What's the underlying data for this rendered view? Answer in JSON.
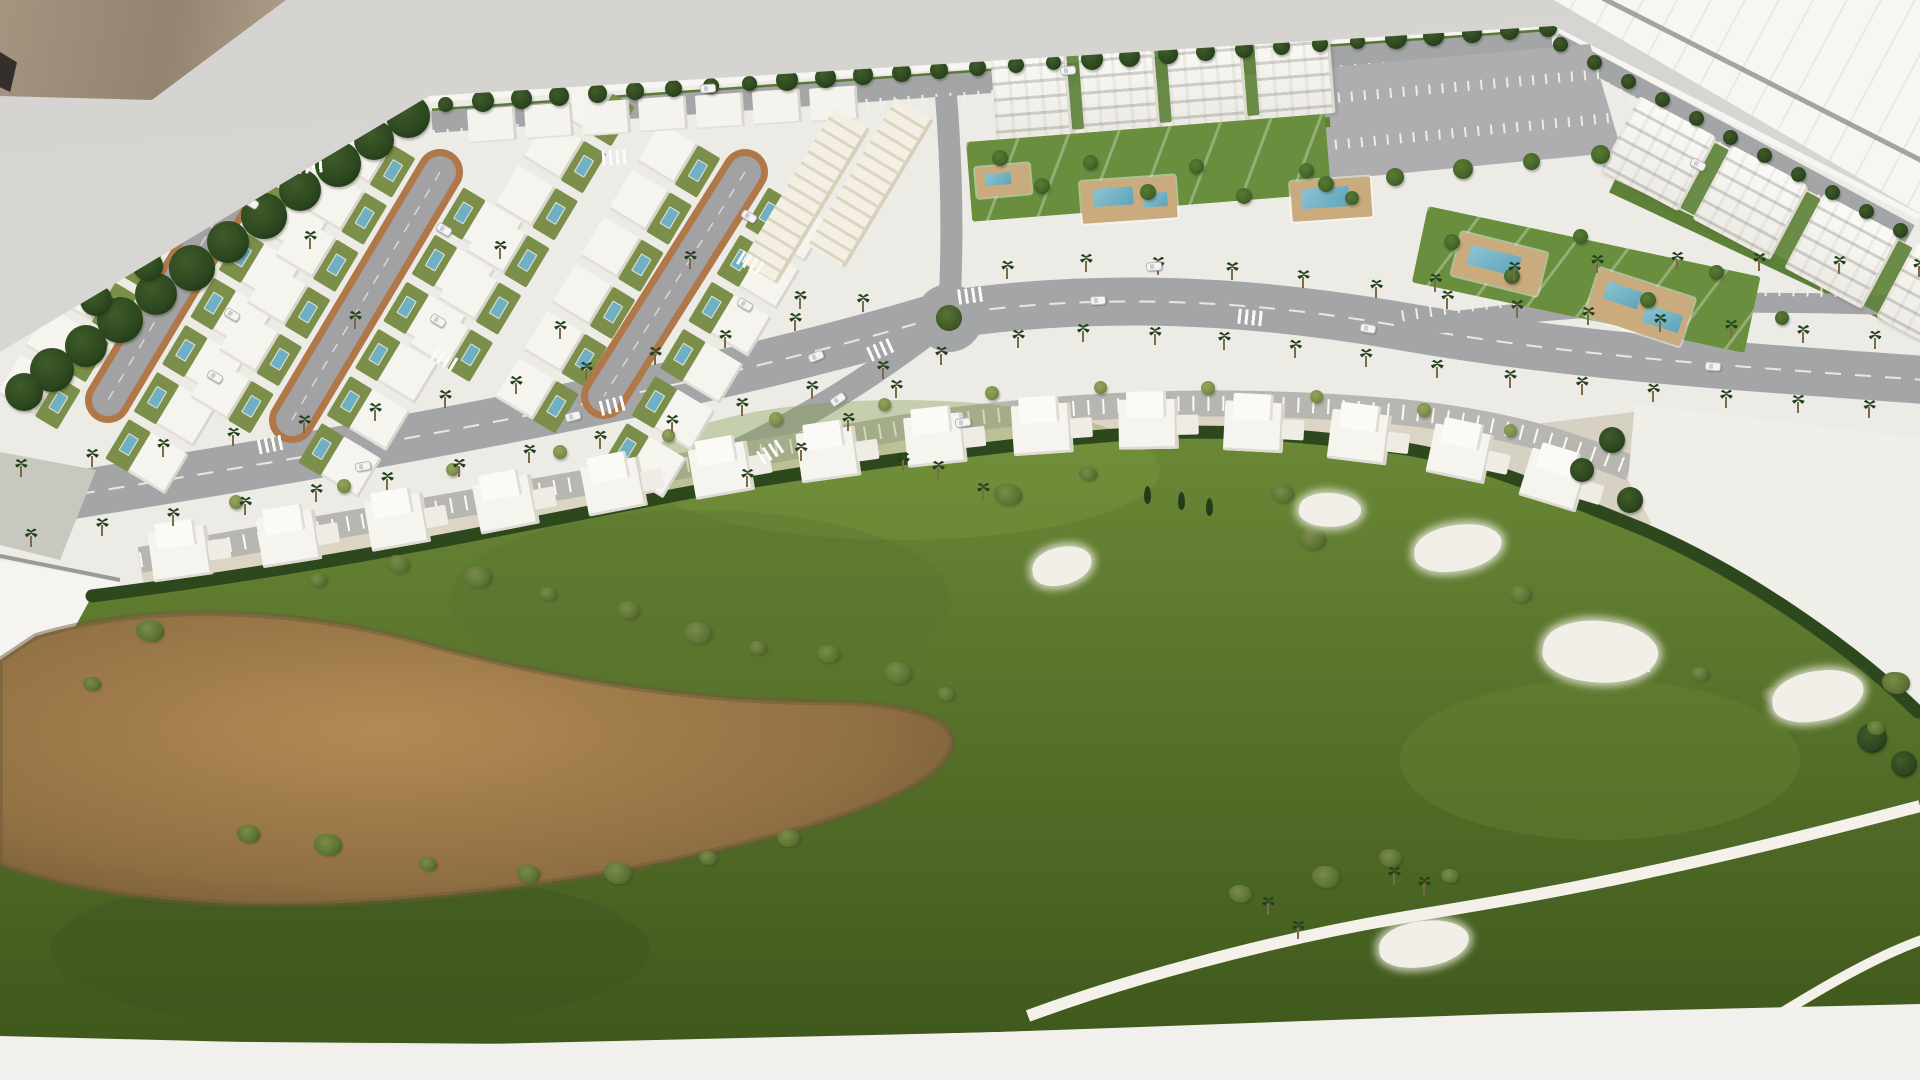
{
  "scene": {
    "type": "photograph",
    "subject": "architectural scale model (maquette) of a golf resort residential development with villa streets, apartment blocks, palm-lined avenue, roundabout and golf course",
    "palette": {
      "backdrop": "#d7d6d2",
      "wall": "#9c8d7b",
      "window_glare": "#f7f6f3",
      "model_base": "#ecebe6",
      "asphalt": "#a4a5a7",
      "brick_edging": "#b07848",
      "lawn": "#5d8136",
      "villa_yard": "#7c8f4a",
      "hedge": "#2e481d",
      "golf_green": "#6b8836",
      "golf_green_dark": "#3f581c",
      "waste_sand": "#b38a55",
      "bunker_sand": "#f2efe8",
      "pool_water": "#6fb0c4",
      "pool_deck": "#c9ab7e",
      "building_white": "#f6f4ef",
      "townhouse_cream": "#f2ede1",
      "tree_dark": "#2c471f",
      "tree": "#44652a",
      "tree_light": "#7b8d49",
      "palm": "#1d3a1a",
      "flag_red": "#c62f2a"
    },
    "villa_streets": {
      "rot": 31,
      "count": 6,
      "step": 55,
      "w": 70,
      "h": 48,
      "anchors": [
        [
          247,
          168
        ],
        [
          440,
          172
        ],
        [
          745,
          172
        ]
      ],
      "cols": [
        [
          -98,
          28
        ],
        [
          -98,
          28
        ],
        [
          -198,
          -98,
          28
        ]
      ]
    },
    "top_blocks": [
      [
        468,
        108
      ],
      [
        525,
        104
      ],
      [
        582,
        101
      ],
      [
        639,
        97
      ],
      [
        696,
        94
      ],
      [
        753,
        90
      ],
      [
        810,
        87
      ]
    ],
    "townhouses": [
      {
        "x": 834,
        "y": 108,
        "rot": 31,
        "w": 42,
        "h": 180
      },
      {
        "x": 896,
        "y": 98,
        "rot": 31,
        "w": 44,
        "h": 172
      }
    ],
    "apartments": [
      {
        "x": 990,
        "y": 54,
        "rot": -4.5,
        "count": 4,
        "bw": 76,
        "bh": 86,
        "gap": 12
      },
      {
        "x": 1640,
        "y": 96,
        "rot": 28,
        "count": 5,
        "bw": 88,
        "bh": 84,
        "gap": 16
      }
    ],
    "gardens": [
      {
        "x": 966,
        "y": 142,
        "rot": -4.5,
        "w": 360,
        "h": 80
      },
      {
        "x": 1428,
        "y": 206,
        "rot": 12,
        "w": 340,
        "h": 78
      }
    ],
    "pools": [
      {
        "x": 975,
        "y": 168,
        "w": 54,
        "h": 30,
        "rot": -5,
        "waters": [
          [
            9,
            7,
            26,
            12
          ]
        ]
      },
      {
        "x": 1080,
        "y": 182,
        "w": 95,
        "h": 42,
        "rot": -4,
        "waters": [
          [
            12,
            8,
            40,
            18
          ],
          [
            62,
            16,
            24,
            14
          ]
        ]
      },
      {
        "x": 1290,
        "y": 182,
        "w": 80,
        "h": 40,
        "rot": -4,
        "waters": [
          [
            10,
            8,
            48,
            20
          ]
        ]
      },
      {
        "x": 1462,
        "y": 232,
        "w": 88,
        "h": 44,
        "rot": 14,
        "waters": [
          [
            12,
            10,
            52,
            20
          ]
        ]
      },
      {
        "x": 1600,
        "y": 268,
        "w": 100,
        "h": 50,
        "rot": 18,
        "waters": [
          [
            12,
            10,
            36,
            18
          ],
          [
            56,
            20,
            38,
            18
          ]
        ]
      }
    ],
    "lower_villas": [
      [
        140,
        524,
        -8
      ],
      [
        248,
        510,
        -9
      ],
      [
        356,
        494,
        -10
      ],
      [
        464,
        477,
        -11
      ],
      [
        572,
        459,
        -11
      ],
      [
        680,
        442,
        -10
      ],
      [
        788,
        425,
        -8
      ],
      [
        896,
        409,
        -6
      ],
      [
        1004,
        397,
        -4
      ],
      [
        1112,
        390,
        -1
      ],
      [
        1220,
        390,
        3
      ],
      [
        1328,
        398,
        7
      ],
      [
        1432,
        412,
        12
      ],
      [
        1530,
        436,
        17
      ]
    ],
    "roundabout": {
      "x": 949,
      "y": 318,
      "bush": 26
    },
    "flag": {
      "x": 1648,
      "y": 648
    },
    "bunkers": [
      [
        1062,
        566,
        60,
        38,
        -8
      ],
      [
        1330,
        510,
        62,
        34,
        6
      ],
      [
        1458,
        548,
        88,
        46,
        -5
      ],
      [
        1600,
        652,
        115,
        62,
        8
      ],
      [
        1818,
        696,
        92,
        50,
        -6
      ],
      [
        1424,
        944,
        90,
        46,
        -4
      ]
    ],
    "cars": [
      [
        700,
        84,
        -4
      ],
      [
        1060,
        66,
        -4
      ],
      [
        1690,
        160,
        28
      ],
      [
        243,
        198,
        31
      ],
      [
        224,
        310,
        31
      ],
      [
        207,
        372,
        31
      ],
      [
        436,
        225,
        31
      ],
      [
        430,
        316,
        31
      ],
      [
        741,
        212,
        31
      ],
      [
        737,
        300,
        31
      ],
      [
        355,
        462,
        -10
      ],
      [
        565,
        412,
        -14
      ],
      [
        808,
        352,
        -22
      ],
      [
        1090,
        296,
        -3
      ],
      [
        1360,
        324,
        9
      ],
      [
        1705,
        362,
        4
      ],
      [
        830,
        395,
        -35
      ],
      [
        955,
        418,
        -8
      ],
      [
        1146,
        262,
        -4
      ]
    ],
    "zebras": [
      [
        258,
        437,
        -12
      ],
      [
        600,
        398,
        -14
      ],
      [
        868,
        342,
        -24
      ],
      [
        958,
        288,
        -8
      ],
      [
        758,
        444,
        -33
      ],
      [
        1238,
        310,
        6
      ],
      [
        602,
        150,
        -4
      ],
      [
        298,
        158,
        -4
      ],
      [
        432,
        352,
        31
      ],
      [
        738,
        256,
        31
      ]
    ],
    "tree_lines": [
      {
        "pts": [
          [
            445,
            104
          ],
          [
            1548,
            28
          ]
        ],
        "n": 30,
        "smin": 15,
        "smax": 22,
        "cls": "tree dark"
      },
      {
        "pts": [
          [
            1560,
            44
          ],
          [
            1900,
            230
          ]
        ],
        "n": 11,
        "smin": 15,
        "smax": 21,
        "cls": "tree dark"
      },
      {
        "pts": [
          [
            1326,
            184
          ],
          [
            1600,
            154
          ]
        ],
        "n": 5,
        "smin": 16,
        "smax": 20,
        "cls": "tree"
      }
    ],
    "palm_lines": [
      {
        "pts": [
          [
            -10,
            508
          ],
          [
            200,
            478
          ],
          [
            420,
            440
          ],
          [
            640,
            396
          ],
          [
            820,
            352
          ],
          [
            945,
            315
          ],
          [
            1060,
            297
          ],
          [
            1200,
            303
          ],
          [
            1350,
            320
          ],
          [
            1500,
            343
          ],
          [
            1700,
            362
          ],
          [
            1920,
            378
          ]
        ],
        "spacing": 72,
        "offsets": [
          -35,
          35
        ],
        "avoid": [
          949,
          318,
          62
        ]
      },
      {
        "pts": [
          [
            948,
            318
          ],
          [
            860,
            384
          ],
          [
            770,
            440
          ],
          [
            700,
            470
          ]
        ],
        "spacing": 56,
        "offsets": [
          -26
        ]
      },
      {
        "pts": [
          [
            1400,
            318
          ],
          [
            1550,
            296
          ],
          [
            1700,
            290
          ],
          [
            1920,
            298
          ]
        ],
        "spacing": 80,
        "offsets": [
          -30
        ]
      }
    ],
    "trees_dark": [
      [
        408,
        116,
        44
      ],
      [
        374,
        140,
        40
      ],
      [
        338,
        164,
        46
      ],
      [
        300,
        190,
        42
      ],
      [
        264,
        216,
        46
      ],
      [
        228,
        242,
        42
      ],
      [
        192,
        268,
        46
      ],
      [
        156,
        294,
        42
      ],
      [
        120,
        320,
        46
      ],
      [
        86,
        346,
        42
      ],
      [
        52,
        370,
        44
      ],
      [
        24,
        392,
        38
      ],
      [
        96,
        300,
        32
      ],
      [
        148,
        266,
        30
      ],
      [
        1612,
        440,
        26
      ],
      [
        1582,
        470,
        24
      ],
      [
        1630,
        500,
        26
      ],
      [
        1872,
        738,
        30
      ],
      [
        1904,
        764,
        26
      ]
    ],
    "trees_std": [
      [
        1000,
        158,
        16
      ],
      [
        1042,
        186,
        16
      ],
      [
        1090,
        162,
        15
      ],
      [
        1148,
        192,
        16
      ],
      [
        1196,
        166,
        15
      ],
      [
        1244,
        196,
        16
      ],
      [
        1306,
        170,
        15
      ],
      [
        1352,
        198,
        14
      ],
      [
        1452,
        242,
        16
      ],
      [
        1512,
        276,
        16
      ],
      [
        1580,
        236,
        15
      ],
      [
        1648,
        300,
        16
      ],
      [
        1716,
        272,
        15
      ],
      [
        1782,
        318,
        14
      ]
    ],
    "trees_light": [
      [
        236,
        502,
        14
      ],
      [
        344,
        486,
        14
      ],
      [
        452,
        469,
        13
      ],
      [
        560,
        452,
        14
      ],
      [
        668,
        435,
        13
      ],
      [
        776,
        419,
        14
      ],
      [
        884,
        404,
        13
      ],
      [
        992,
        393,
        14
      ],
      [
        1100,
        387,
        13
      ],
      [
        1208,
        388,
        14
      ],
      [
        1316,
        396,
        13
      ],
      [
        1424,
        410,
        14
      ],
      [
        1510,
        430,
        13
      ]
    ],
    "bushes": [
      [
        318,
        582
      ],
      [
        398,
        566
      ],
      [
        478,
        580
      ],
      [
        548,
        596
      ],
      [
        628,
        612
      ],
      [
        698,
        636
      ],
      [
        758,
        650
      ],
      [
        828,
        656
      ],
      [
        898,
        676
      ],
      [
        946,
        696
      ],
      [
        248,
        836
      ],
      [
        328,
        848
      ],
      [
        428,
        866
      ],
      [
        528,
        876
      ],
      [
        618,
        876
      ],
      [
        708,
        860
      ],
      [
        788,
        840
      ],
      [
        150,
        634
      ],
      [
        92,
        686
      ],
      [
        1282,
        496
      ],
      [
        1312,
        542
      ],
      [
        1422,
        543
      ],
      [
        1520,
        596
      ],
      [
        1562,
        638
      ],
      [
        1700,
        676
      ],
      [
        1772,
        698
      ],
      [
        1896,
        686
      ],
      [
        1876,
        730
      ],
      [
        1240,
        896
      ],
      [
        1326,
        880
      ],
      [
        1450,
        878
      ],
      [
        1390,
        860
      ],
      [
        1008,
        498
      ],
      [
        1088,
        476
      ]
    ],
    "cypresses": [
      [
        1144,
        486
      ],
      [
        1178,
        492
      ],
      [
        1206,
        498
      ]
    ],
    "palms_extra": [
      [
        903,
        462
      ],
      [
        938,
        470
      ],
      [
        983,
        492
      ],
      [
        1394,
        876
      ],
      [
        1424,
        886
      ],
      [
        1298,
        930
      ],
      [
        1268,
        906
      ],
      [
        310,
        240
      ],
      [
        355,
        320
      ],
      [
        500,
        250
      ],
      [
        560,
        330
      ],
      [
        690,
        260
      ],
      [
        800,
        300
      ]
    ]
  }
}
